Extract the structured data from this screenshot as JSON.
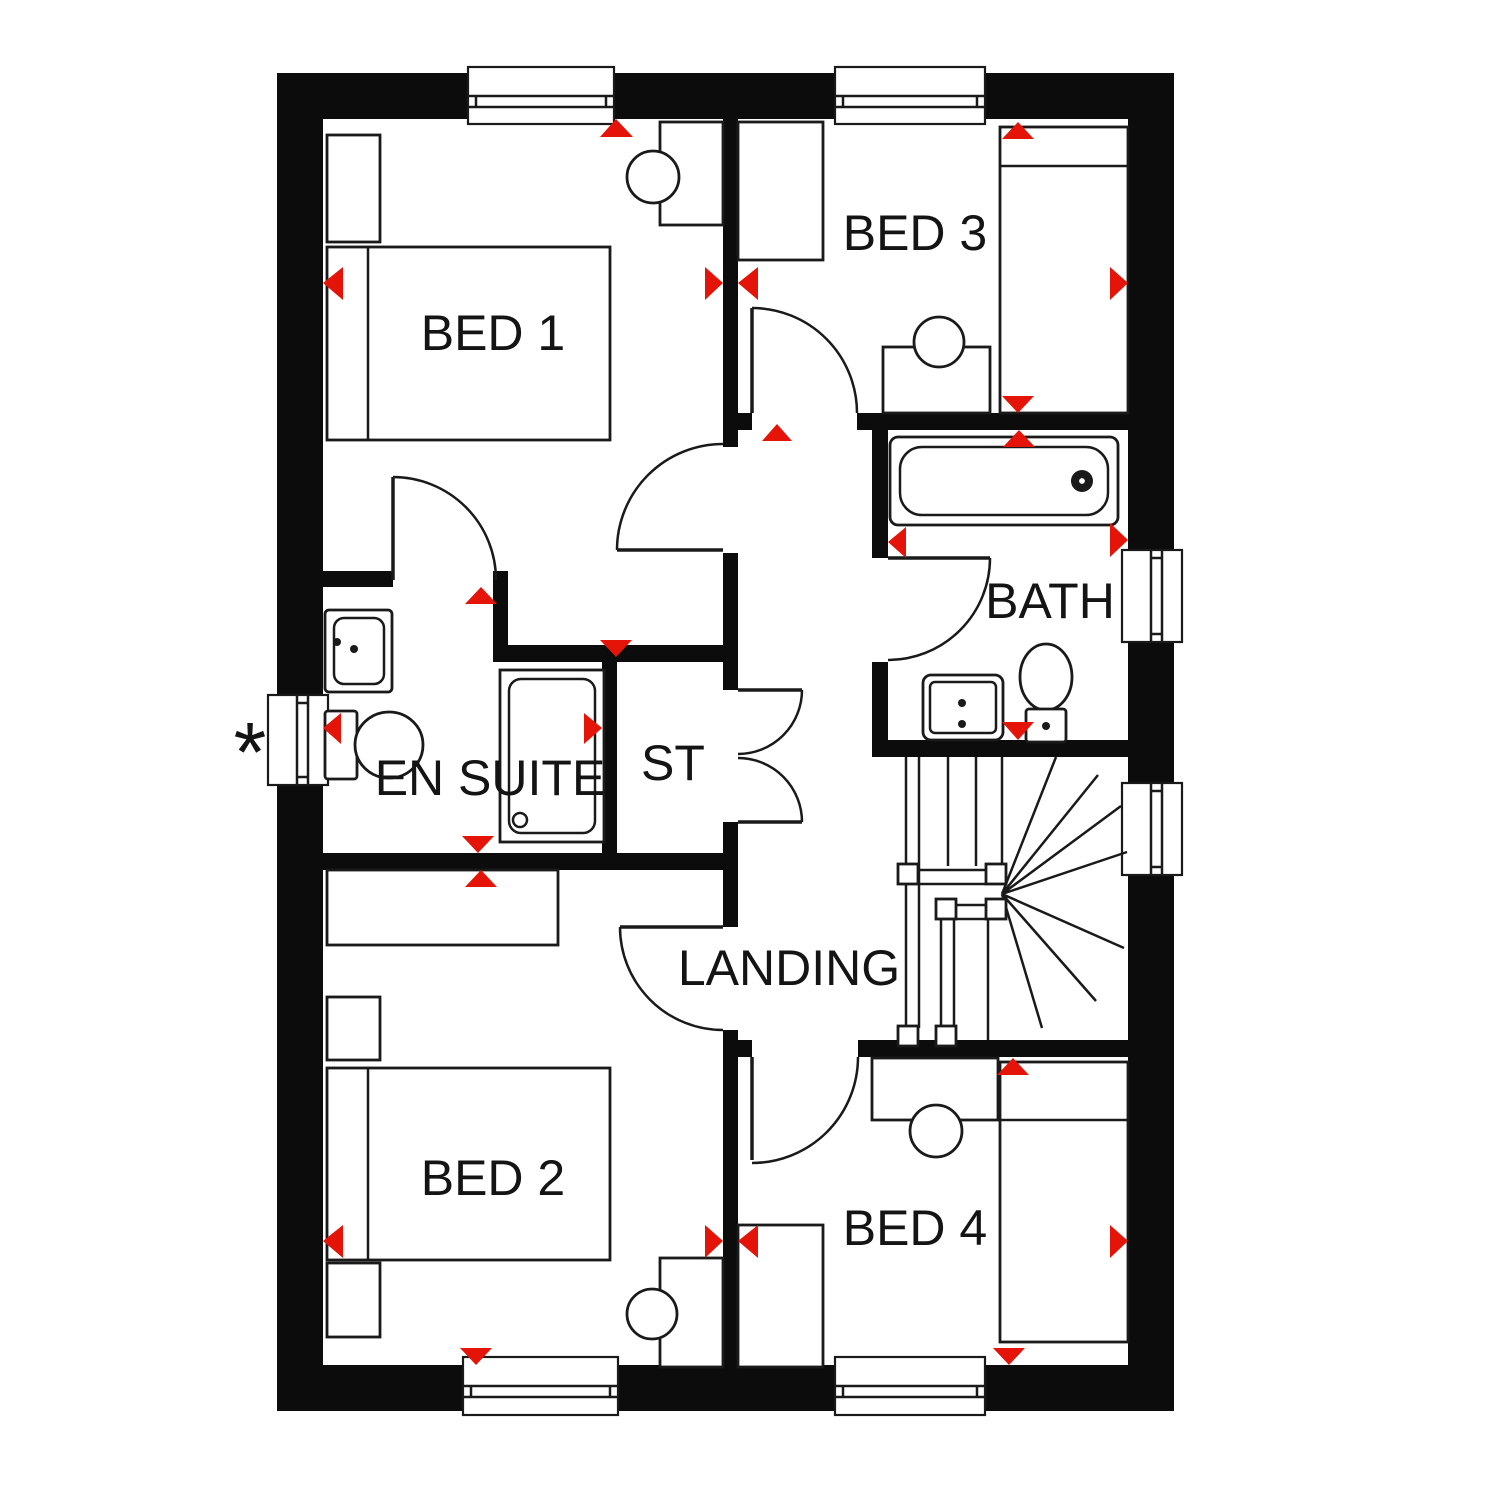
{
  "rooms": {
    "bed1": {
      "label": "BED 1"
    },
    "bed2": {
      "label": "BED 2"
    },
    "bed3": {
      "label": "BED 3"
    },
    "bed4": {
      "label": "BED 4"
    },
    "bath": {
      "label": "BATH"
    },
    "ensuite": {
      "label": "EN SUITE"
    },
    "store": {
      "label": "ST"
    },
    "landing": {
      "label": "LANDING"
    }
  },
  "annotations": {
    "asterisk": "*"
  },
  "colors": {
    "wall": "#0c0c0c",
    "line": "#1a1a1a",
    "marker": "#e41408",
    "background": "#ffffff"
  }
}
